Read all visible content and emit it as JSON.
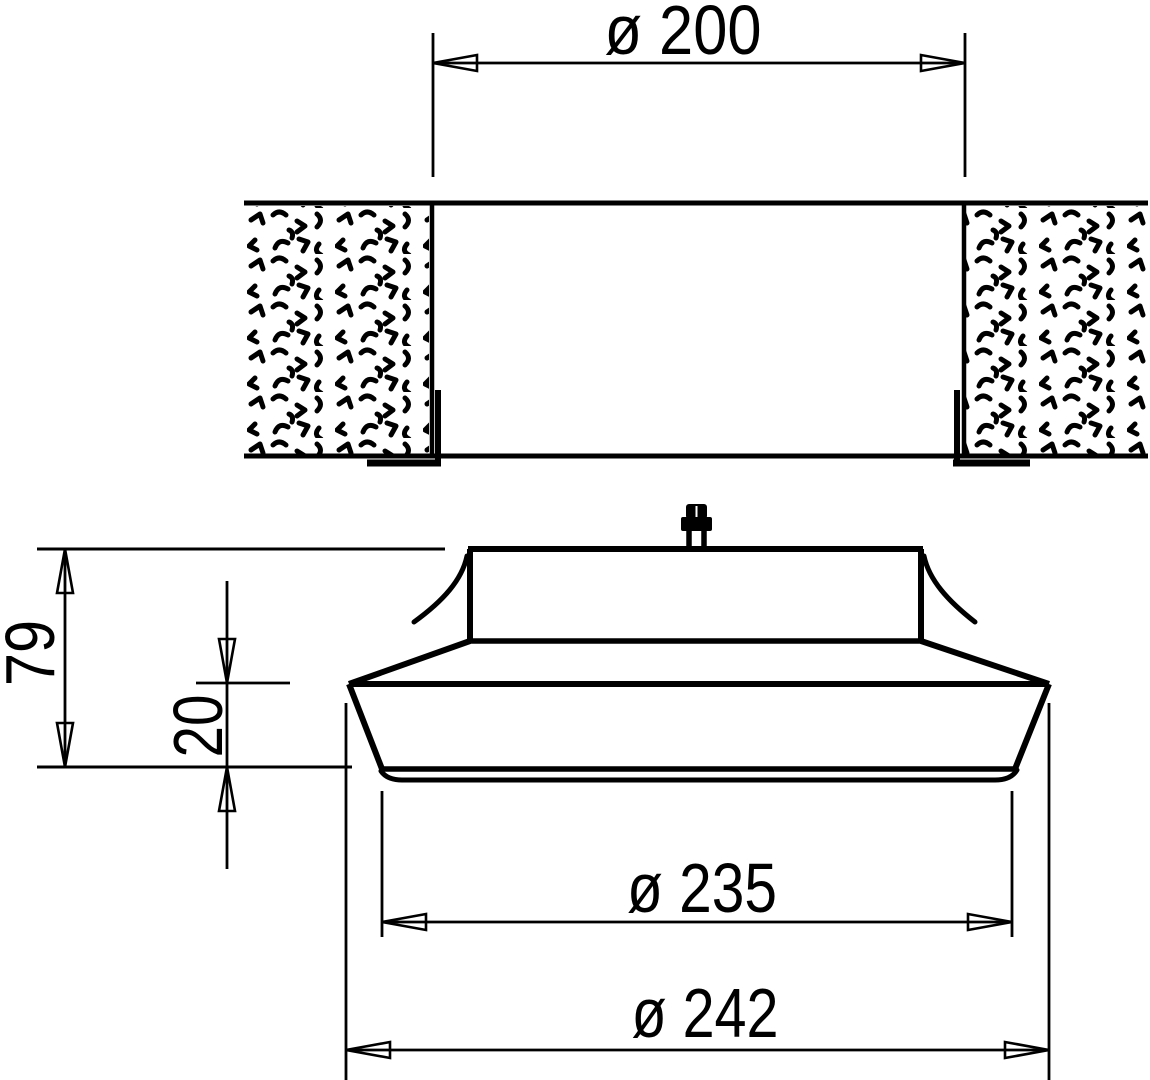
{
  "drawing": {
    "labels": {
      "duct_diameter": "ø 200",
      "overall_height": "79",
      "face_height": "20",
      "face_diameter": "ø 235",
      "flange_diameter": "ø 242"
    },
    "colors": {
      "line": "#000000",
      "background": "#ffffff"
    }
  }
}
